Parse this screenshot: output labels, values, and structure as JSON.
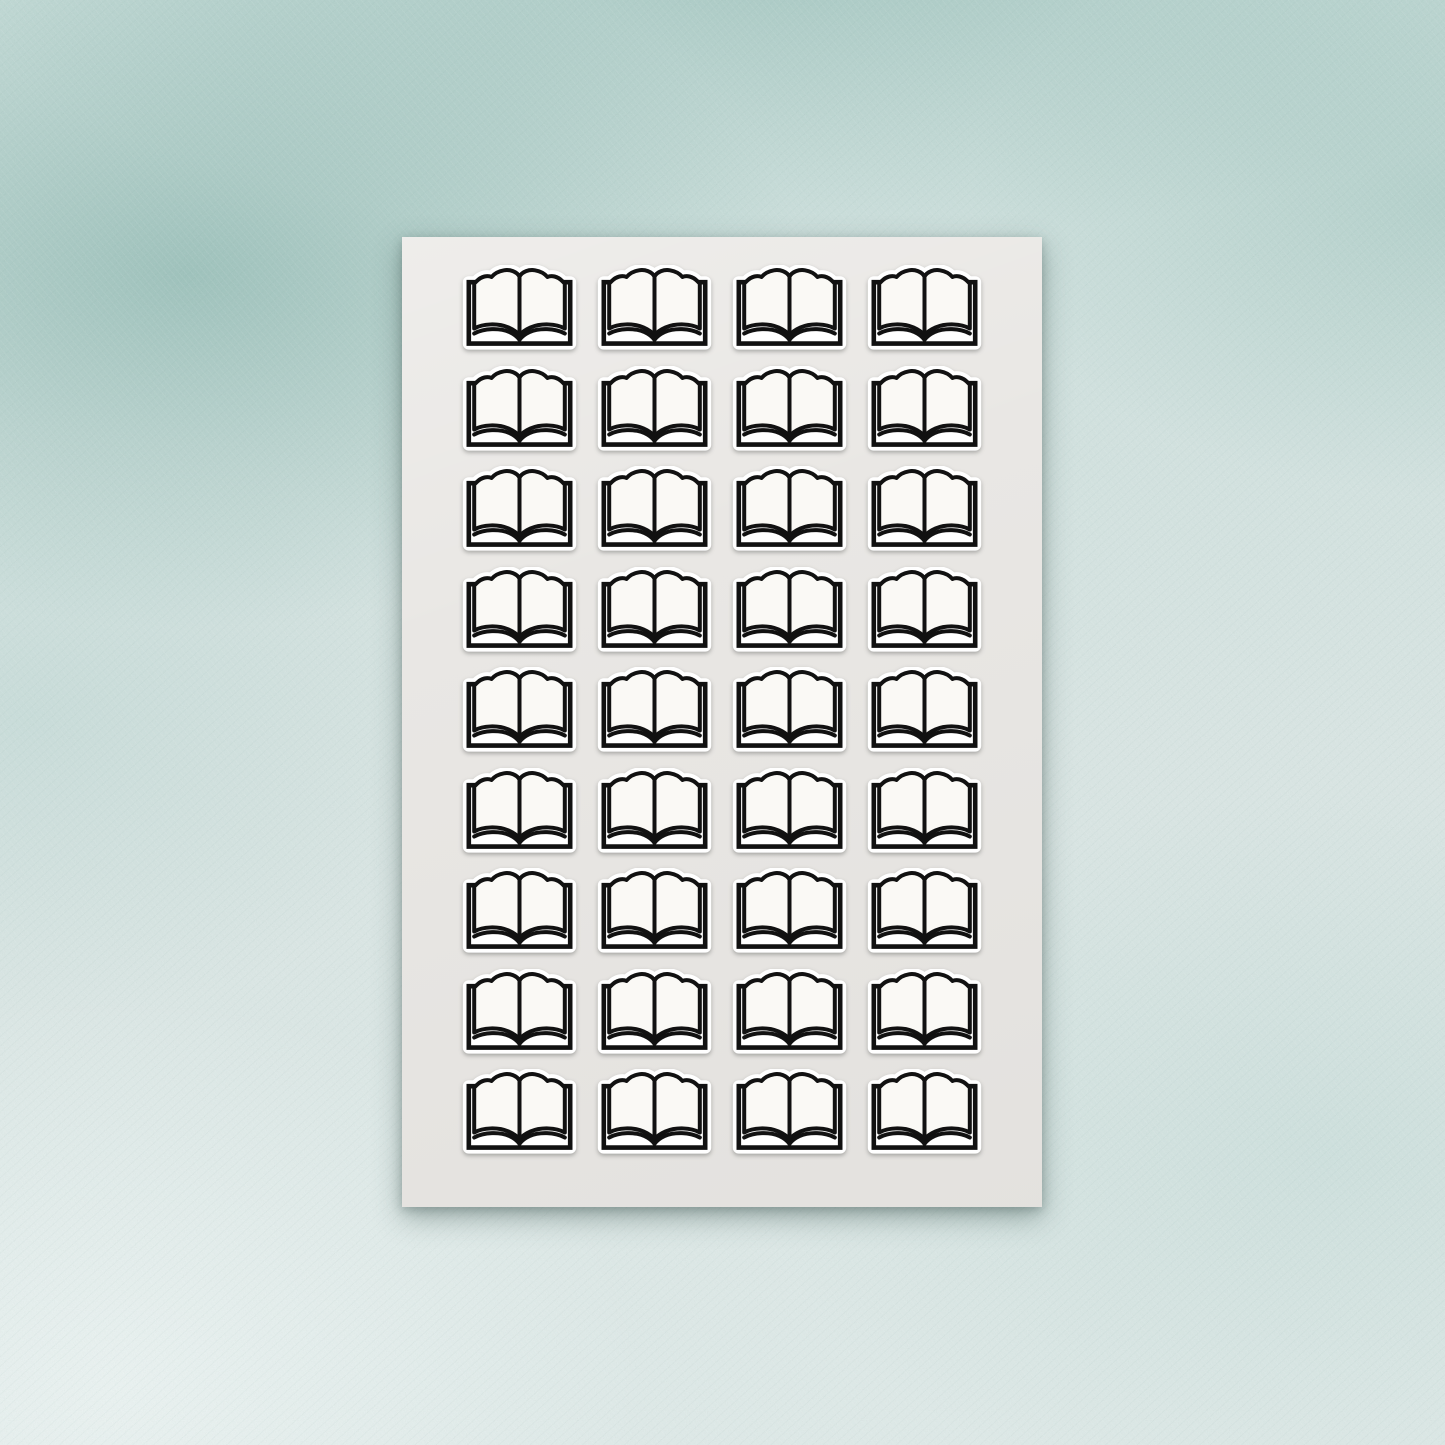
{
  "scene": {
    "kind": "sticker-sheet-product-mockup",
    "background_texture": "teal-watercolor-paper"
  },
  "sticker_sheet": {
    "rows": 9,
    "columns": 4,
    "sticker_count": 36,
    "icon": "open-book-icon"
  },
  "colors": {
    "background_base": "#d8e5e3",
    "background_teal_dark": "#8fbdb4",
    "background_teal_mid": "#b4d5cf",
    "background_light": "#e9f1ef",
    "sheet": "#e9e7e4",
    "sticker_diecut": "#ffffff",
    "icon_line": "#111111",
    "page_fill": "#faf9f5"
  }
}
